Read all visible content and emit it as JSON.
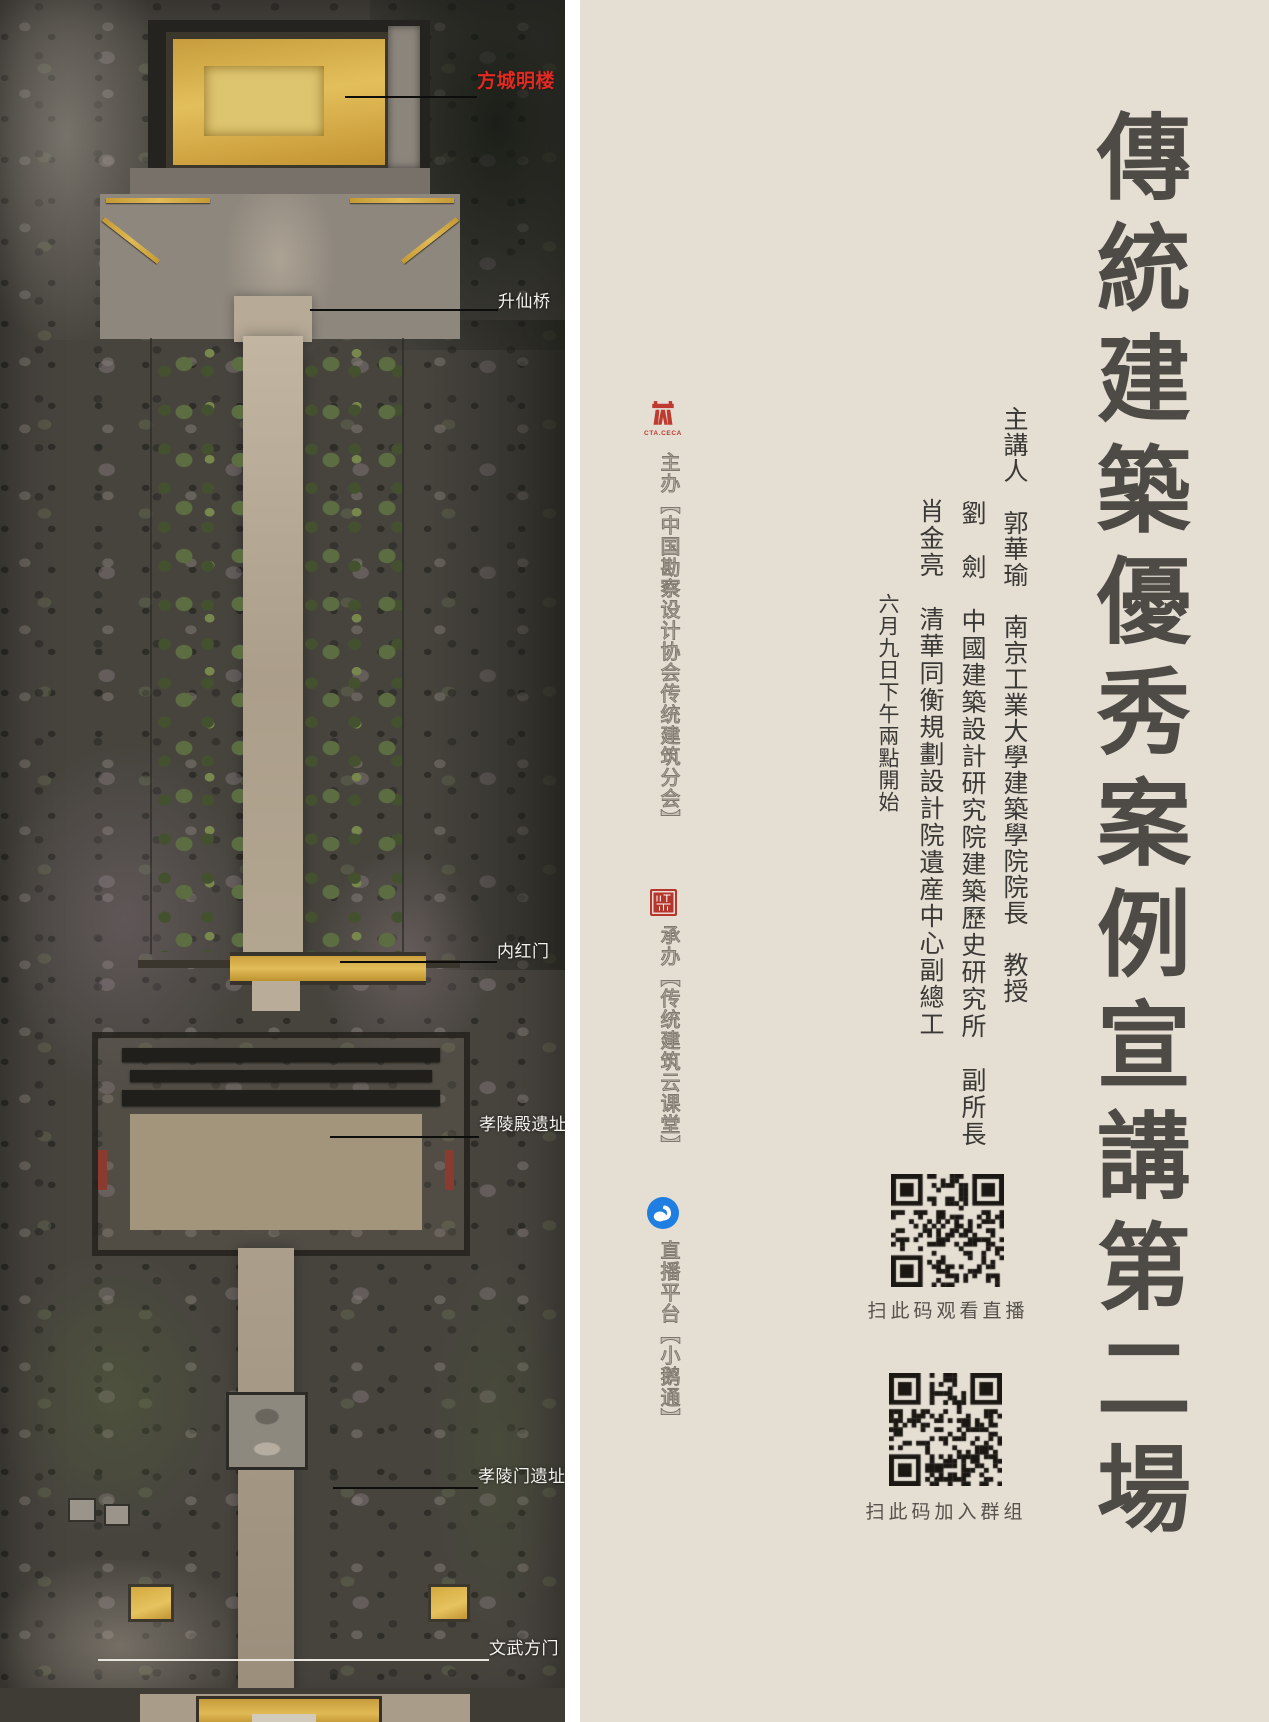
{
  "photo": {
    "labels": [
      {
        "id": "fangcheng-minglou",
        "text": "方城明楼",
        "color": "#e02a22"
      },
      {
        "id": "shengxianqiao",
        "text": "升仙桥",
        "color": "#f5f3ef"
      },
      {
        "id": "neihongmen",
        "text": "内红门",
        "color": "#f5f3ef"
      },
      {
        "id": "xiaolingdian-yizhi",
        "text": "孝陵殿遗址",
        "color": "#f5f3ef"
      },
      {
        "id": "xiaolingmen-yizhi",
        "text": "孝陵门遗址",
        "color": "#f5f3ef"
      },
      {
        "id": "wenwufangmen",
        "text": "文武方门",
        "color": "#f5f3ef"
      }
    ]
  },
  "panel": {
    "title": "傳統建築優秀案例宣講第二場",
    "speakers": [
      "主講人　郭華瑜　南京工業大學建築學院院長　教授",
      "劉　劍　中國建築設計研究院建築歷史研究所　副所長",
      "肖金亮　清華同衡規劃設計院遺産中心副總工",
      "六月九日下午兩點開始"
    ],
    "organizers": [
      {
        "label": "主办【中国勘察设计协会传统建筑分会】",
        "logo": "cta-ceca-emblem",
        "logo_caption": "CTA.CECA"
      },
      {
        "label": "承办【传统建筑云课堂】",
        "logo": "red-seal"
      },
      {
        "label": "直播平台【小鹅通】",
        "logo": "goose-in-blue-circle"
      }
    ],
    "qr": [
      {
        "caption": "扫此码观看直播"
      },
      {
        "caption": "扫此码加入群组"
      }
    ]
  },
  "colors": {
    "panel_background": "#e4ded3",
    "title_text": "#4e4b46",
    "label_red": "#e02a22",
    "emblem_red": "#bf3a2f",
    "seal_red": "#b5372c",
    "goose_blue": "#1e7ee2",
    "qr_dark": "#1b1713",
    "gold_roof": "#d9ae45"
  }
}
